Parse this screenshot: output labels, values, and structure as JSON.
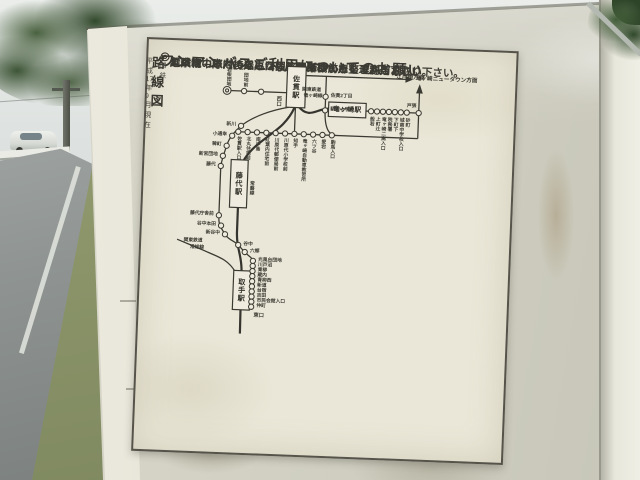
{
  "notice": {
    "bullet": "◎",
    "title": "ワンマンバスご利用についてのお願い",
    "numbers": [
      "1．",
      "2．",
      "3．"
    ],
    "items": [
      "乗車は中扉（後扉）から、降車は前扉をご利用下さい。",
      "ご乗車の際は、乗車口の整理券機から整理券をお取り下さい。",
      "危険物の車内持込みは固くお断りいたします。"
    ]
  },
  "map": {
    "title": "路線図",
    "title_note": "関鉄",
    "as_of": "平成17年9月現在",
    "stations": {
      "sanuki": "佐貫駅",
      "ryugasaki": "竜ヶ崎駅",
      "fujishiro": "藤代駅",
      "toride": "取手駅"
    },
    "exits": {
      "sanuki_east": "東口",
      "sanuki_west": "西口",
      "toride_east": "東口"
    },
    "directions": {
      "newtown": "竜ヶ崎ニュータウン方面",
      "edosaki": "江戸崎方面"
    },
    "rail_lines": {
      "ryutetsu": [
        "関東鉄道",
        "竜ヶ崎線"
      ],
      "joban": "常磐線",
      "joso": [
        "関東鉄道",
        "常総線"
      ]
    },
    "stops": {
      "west": [
        "団地前",
        "若柴団地"
      ],
      "branch": [
        "佐貫2丁目",
        "馴柴小学校"
      ],
      "main": [
        "佐貫駅入口",
        "北丸住宅前",
        "南中島",
        "紅葉内住宅前",
        "川原代郵便局前",
        "川原代小学校前",
        "知手",
        "竜ヶ崎自動車教習所",
        "六ツ谷",
        "愛宕",
        "駒馬入口"
      ],
      "east": [
        "般若",
        "上町辻",
        "竜ヶ崎二高入口",
        "税務署",
        "下町下",
        "城南中学校入口",
        "砂町"
      ],
      "corner": "戸張",
      "southwest": [
        "新川",
        "小通幸",
        "稗町",
        "新宮団地",
        "藤代"
      ],
      "fujishiro_south": [
        "藤代庁舎前",
        "谷中本田",
        "新谷中"
      ],
      "mid": [
        "谷中",
        "六郷"
      ],
      "toride_chain": [
        "光風台団地",
        "川戸沼",
        "青柳",
        "蔵内",
        "青柳西",
        "新道",
        "台宿",
        "吉田",
        "市民会館入口",
        "仲町"
      ]
    }
  },
  "colors": {
    "board": "#d6d4c6",
    "poster": "#eae7d8",
    "ink": "#3b3a32",
    "sky": "#e9ece9",
    "foliage": "#39522f",
    "road": "#8f9492",
    "grass": "#8a9368"
  }
}
